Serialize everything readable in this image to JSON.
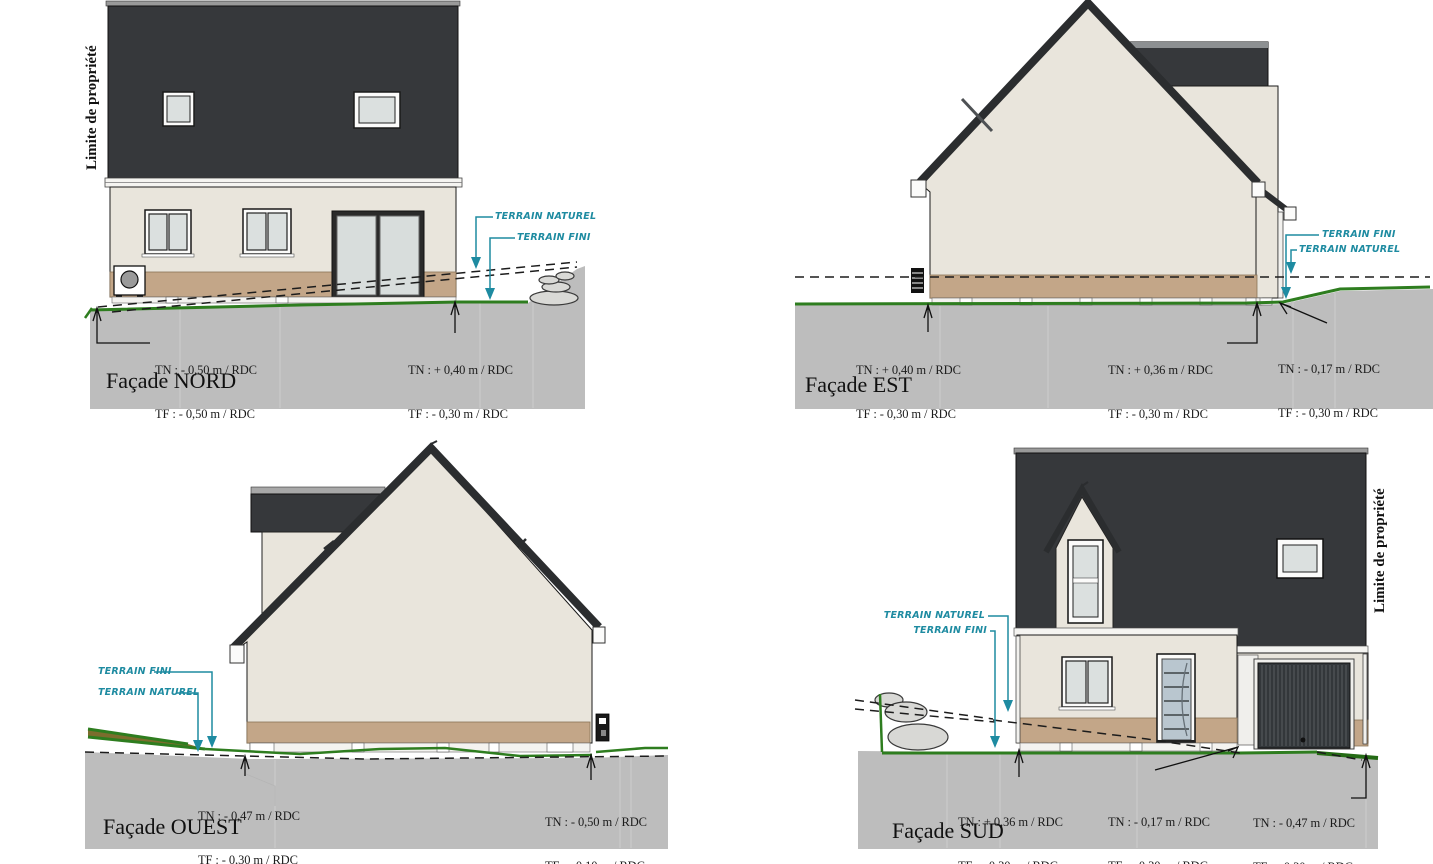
{
  "drawing": {
    "limite_label": "Limite de propriété",
    "terrain_naturel_label": "TERRAIN NATUREL",
    "terrain_fini_label": "TERRAIN FINI"
  },
  "facades": {
    "nord": {
      "title": "Façade NORD",
      "marks": [
        {
          "tn": "TN : - 0,50 m / RDC",
          "tf": "TF : - 0,50 m / RDC"
        },
        {
          "tn": "TN : + 0,40 m / RDC",
          "tf": "TF : - 0,30 m / RDC"
        }
      ]
    },
    "est": {
      "title": "Façade EST",
      "marks": [
        {
          "tn": "TN : + 0,40 m / RDC",
          "tf": "TF : - 0,30 m / RDC"
        },
        {
          "tn": "TN : + 0,36 m / RDC",
          "tf": "TF : - 0,30 m / RDC"
        },
        {
          "tn": "TN : - 0,17 m / RDC",
          "tf": "TF : - 0,30 m / RDC"
        }
      ]
    },
    "ouest": {
      "title": "Façade OUEST",
      "marks": [
        {
          "tn": "TN : - 0,47 m / RDC",
          "tf": "TF : - 0,30 m / RDC"
        },
        {
          "tn": "TN : - 0,50 m / RDC",
          "tf": "TF : - 0,10 m / RDC"
        }
      ]
    },
    "sud": {
      "title": "Façade SUD",
      "marks": [
        {
          "tn": "TN : + 0,36 m / RDC",
          "tf": "TF : - 0,30 m / RDC"
        },
        {
          "tn": "TN : - 0,17 m / RDC",
          "tf": "TF : - 0,30 m / RDC"
        },
        {
          "tn": "TN : - 0,47 m / RDC",
          "tf": "TF : - 0,30 m / RDC"
        }
      ]
    }
  },
  "colors": {
    "roof": "#36383b",
    "wall": "#e9e5dc",
    "base_band": "#c3a688",
    "ground": "#bdbdbd",
    "terrain_green": "#2e7d1f",
    "annotation_teal": "#1e8ba1",
    "line": "#1a1a1a"
  }
}
